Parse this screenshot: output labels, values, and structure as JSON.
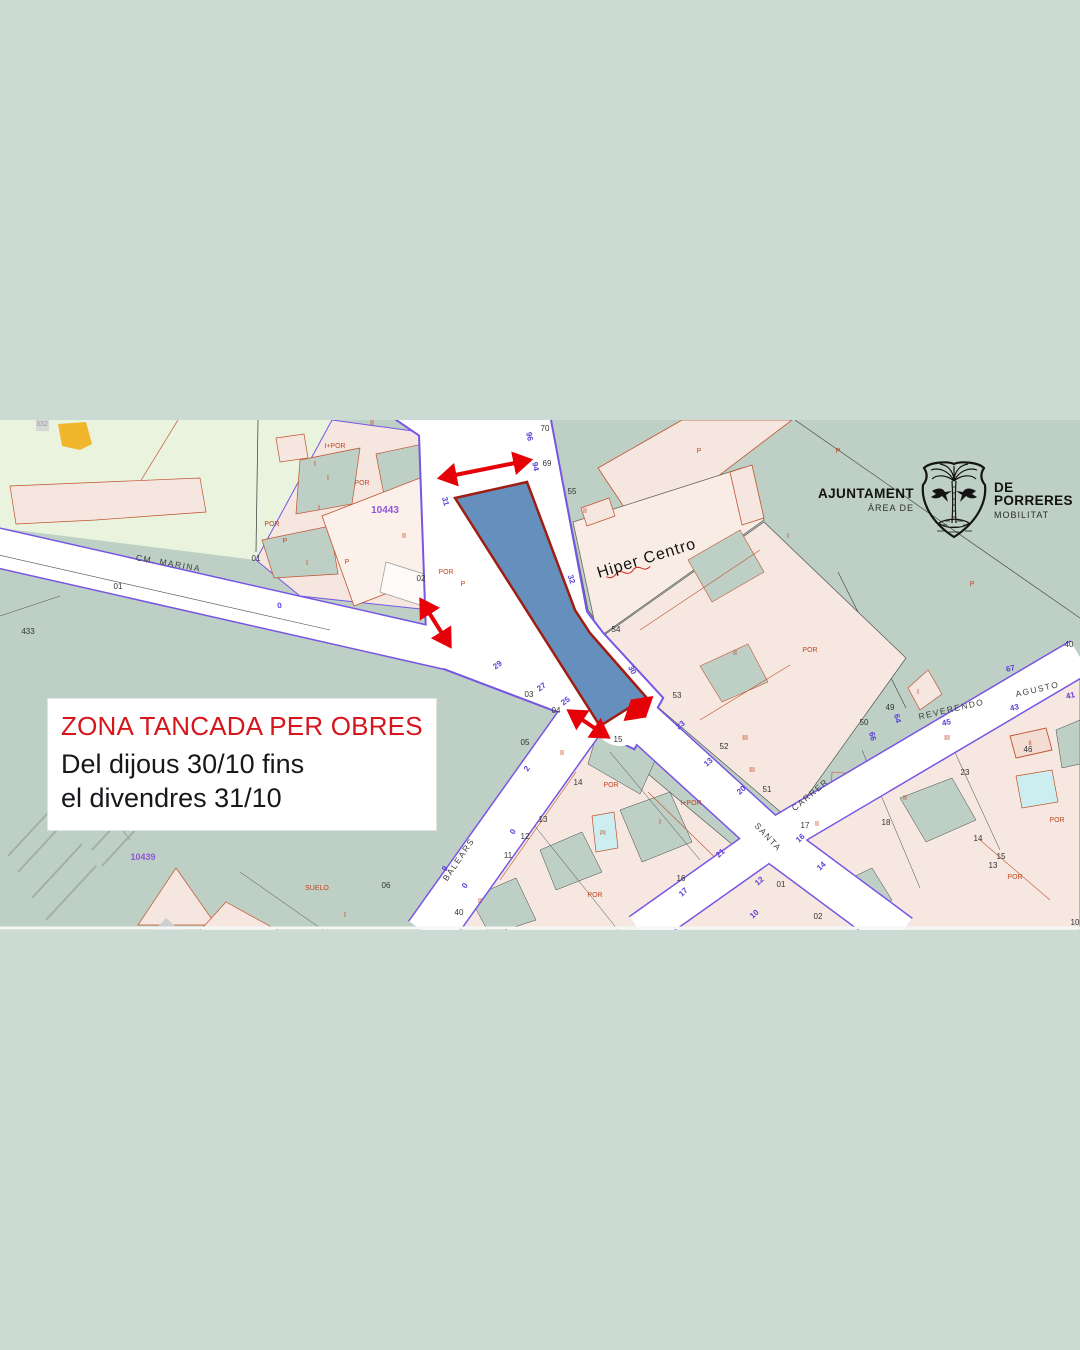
{
  "page": {
    "background": "#cbdad3"
  },
  "notice": {
    "title": "ZONA TANCADA PER OBRES",
    "line1": "Del dijous 30/10 fins",
    "line2": "el divendres 31/10",
    "title_color": "#d6161d"
  },
  "logo": {
    "org": "AJUNTAMENT",
    "org_sub": "ÀREA DE",
    "area": "DE PORRERES",
    "area_sub": "MOBILITAT"
  },
  "map": {
    "colors": {
      "field_light": "#e9f3de",
      "field_sage": "#bed0c5",
      "parcel_pink": "#f6e8e1",
      "parcel_border": "#c0522d",
      "street_line": "#7756e3",
      "pool_cyan": "#cdeef0",
      "zone_fill": "#6590bd",
      "zone_border": "#9f1d12",
      "arrow": "#e60008"
    },
    "arrow_color": "#e60008",
    "closed_zone": {
      "fill": "#6590bd",
      "stroke": "#9f1d12",
      "points": "455,78 527,62 575,190 590,213 646,277 600,306"
    },
    "arrows": [
      {
        "x1": 440,
        "y1": 58,
        "x2": 530,
        "y2": 40
      },
      {
        "x1": 421,
        "y1": 180,
        "x2": 450,
        "y2": 226
      },
      {
        "x1": 569,
        "y1": 291,
        "x2": 608,
        "y2": 317
      },
      {
        "x1": 651,
        "y1": 278,
        "x2": 626,
        "y2": 299
      }
    ],
    "labels": [
      {
        "t": "CM. MARINA",
        "x": 168,
        "y": 146,
        "r": 10,
        "s": 8.5,
        "c": "#3f3f3f",
        "ls": 1.5
      },
      {
        "t": "BALEARS",
        "x": 461,
        "y": 441,
        "r": -56,
        "s": 8.5,
        "c": "#3f3f3f",
        "ls": 1.5
      },
      {
        "t": "SANTA",
        "x": 766,
        "y": 419,
        "r": 47,
        "s": 8.5,
        "c": "#3f3f3f",
        "ls": 1.5
      },
      {
        "t": "CARRER",
        "x": 812,
        "y": 377,
        "r": -40,
        "s": 8.5,
        "c": "#3f3f3f",
        "ls": 1.5
      },
      {
        "t": "REVERENDO",
        "x": 952,
        "y": 292,
        "r": -13,
        "s": 8.5,
        "c": "#3f3f3f",
        "ls": 1.5
      },
      {
        "t": "AGUSTO",
        "x": 1038,
        "y": 272,
        "r": -13,
        "s": 8.5,
        "c": "#3f3f3f",
        "ls": 1.5
      },
      {
        "t": "Hiper Centro",
        "x": 648,
        "y": 143,
        "r": -17,
        "s": 16,
        "c": "#141414",
        "ls": 1
      },
      {
        "t": "332",
        "x": 42,
        "y": 6,
        "s": 7,
        "c": "#999999"
      },
      {
        "t": "70",
        "x": 545,
        "y": 11,
        "s": 8,
        "c": "#333333"
      },
      {
        "t": "69",
        "x": 547,
        "y": 46,
        "s": 8,
        "c": "#333333"
      },
      {
        "t": "55",
        "x": 572,
        "y": 74,
        "s": 8,
        "c": "#333333"
      },
      {
        "t": "54",
        "x": 616,
        "y": 212,
        "s": 8,
        "c": "#333333"
      },
      {
        "t": "53",
        "x": 677,
        "y": 278,
        "s": 8,
        "c": "#333333"
      },
      {
        "t": "52",
        "x": 724,
        "y": 329,
        "s": 8,
        "c": "#333333"
      },
      {
        "t": "51",
        "x": 767,
        "y": 372,
        "s": 8,
        "c": "#333333"
      },
      {
        "t": "50",
        "x": 864,
        "y": 305,
        "s": 8,
        "c": "#333333"
      },
      {
        "t": "49",
        "x": 890,
        "y": 290,
        "s": 8,
        "c": "#333333"
      },
      {
        "t": "40",
        "x": 1069,
        "y": 227,
        "s": 8,
        "c": "#333333"
      },
      {
        "t": "46",
        "x": 1028,
        "y": 332,
        "s": 8,
        "c": "#333333"
      },
      {
        "t": "23",
        "x": 965,
        "y": 355,
        "s": 8,
        "c": "#333333"
      },
      {
        "t": "17",
        "x": 805,
        "y": 408,
        "s": 8,
        "c": "#333333"
      },
      {
        "t": "18",
        "x": 886,
        "y": 405,
        "s": 8,
        "c": "#333333"
      },
      {
        "t": "14",
        "x": 978,
        "y": 421,
        "s": 8,
        "c": "#333333"
      },
      {
        "t": "15",
        "x": 1001,
        "y": 439,
        "s": 8,
        "c": "#333333"
      },
      {
        "t": "13",
        "x": 993,
        "y": 448,
        "s": 8,
        "c": "#333333"
      },
      {
        "t": "10",
        "x": 1075,
        "y": 505,
        "s": 8,
        "c": "#333333"
      },
      {
        "t": "02",
        "x": 421,
        "y": 161,
        "s": 8,
        "c": "#333333"
      },
      {
        "t": "01",
        "x": 256,
        "y": 141,
        "s": 8,
        "c": "#333333"
      },
      {
        "t": "433",
        "x": 28,
        "y": 214,
        "s": 8,
        "c": "#333333"
      },
      {
        "t": "01",
        "x": 118,
        "y": 169,
        "s": 8,
        "c": "#333333"
      },
      {
        "t": "03",
        "x": 529,
        "y": 277,
        "s": 8,
        "c": "#333333"
      },
      {
        "t": "04",
        "x": 556,
        "y": 293,
        "s": 8,
        "c": "#333333"
      },
      {
        "t": "05",
        "x": 525,
        "y": 325,
        "s": 8,
        "c": "#333333"
      },
      {
        "t": "06",
        "x": 386,
        "y": 468,
        "s": 8,
        "c": "#333333"
      },
      {
        "t": "15",
        "x": 618,
        "y": 322,
        "s": 8,
        "c": "#333333"
      },
      {
        "t": "14",
        "x": 578,
        "y": 365,
        "s": 8,
        "c": "#333333"
      },
      {
        "t": "13",
        "x": 543,
        "y": 402,
        "s": 8,
        "c": "#333333"
      },
      {
        "t": "12",
        "x": 525,
        "y": 419,
        "s": 8,
        "c": "#333333"
      },
      {
        "t": "11",
        "x": 508,
        "y": 438,
        "s": 8,
        "c": "#333333"
      },
      {
        "t": "40",
        "x": 459,
        "y": 495,
        "s": 8,
        "c": "#333333"
      },
      {
        "t": "16",
        "x": 681,
        "y": 461,
        "s": 8,
        "c": "#333333"
      },
      {
        "t": "01",
        "x": 781,
        "y": 467,
        "s": 8,
        "c": "#333333"
      },
      {
        "t": "02",
        "x": 818,
        "y": 499,
        "s": 8,
        "c": "#333333"
      },
      {
        "t": "10443",
        "x": 385,
        "y": 93,
        "s": 10,
        "c": "#9257d8",
        "w": "bold"
      },
      {
        "t": "10439",
        "x": 143,
        "y": 440,
        "s": 9,
        "c": "#9257d8",
        "w": "bold"
      },
      {
        "t": "96",
        "x": 527,
        "y": 17,
        "r": 78,
        "s": 8,
        "c": "#5b3fd8",
        "w": "bold"
      },
      {
        "t": "94",
        "x": 533,
        "y": 47,
        "r": 78,
        "s": 8,
        "c": "#5b3fd8",
        "w": "bold"
      },
      {
        "t": "31",
        "x": 443,
        "y": 82,
        "r": 75,
        "s": 8,
        "c": "#5b3fd8",
        "w": "bold"
      },
      {
        "t": "32",
        "x": 569,
        "y": 160,
        "r": 72,
        "s": 8,
        "c": "#5b3fd8",
        "w": "bold"
      },
      {
        "t": "30",
        "x": 630,
        "y": 251,
        "r": 62,
        "s": 8,
        "c": "#5b3fd8",
        "w": "bold"
      },
      {
        "t": "0",
        "x": 280,
        "y": 188,
        "r": -12,
        "s": 8,
        "c": "#5b3fd8",
        "w": "bold"
      },
      {
        "t": "29",
        "x": 499,
        "y": 247,
        "r": -36,
        "s": 8,
        "c": "#5b3fd8",
        "w": "bold"
      },
      {
        "t": "27",
        "x": 543,
        "y": 269,
        "r": -36,
        "s": 8,
        "c": "#5b3fd8",
        "w": "bold"
      },
      {
        "t": "25",
        "x": 567,
        "y": 283,
        "r": -36,
        "s": 8,
        "c": "#5b3fd8",
        "w": "bold"
      },
      {
        "t": "23",
        "x": 682,
        "y": 307,
        "r": -38,
        "s": 8,
        "c": "#5b3fd8",
        "w": "bold"
      },
      {
        "t": "13",
        "x": 710,
        "y": 344,
        "r": -42,
        "s": 8,
        "c": "#5b3fd8",
        "w": "bold"
      },
      {
        "t": "20",
        "x": 743,
        "y": 372,
        "r": -42,
        "s": 8,
        "c": "#5b3fd8",
        "w": "bold"
      },
      {
        "t": "21",
        "x": 722,
        "y": 435,
        "r": -42,
        "s": 8,
        "c": "#5b3fd8",
        "w": "bold"
      },
      {
        "t": "16",
        "x": 802,
        "y": 420,
        "r": -42,
        "s": 8,
        "c": "#5b3fd8",
        "w": "bold"
      },
      {
        "t": "14",
        "x": 823,
        "y": 448,
        "r": -42,
        "s": 8,
        "c": "#5b3fd8",
        "w": "bold"
      },
      {
        "t": "12",
        "x": 761,
        "y": 463,
        "r": -42,
        "s": 8,
        "c": "#5b3fd8",
        "w": "bold"
      },
      {
        "t": "17",
        "x": 685,
        "y": 474,
        "r": -42,
        "s": 8,
        "c": "#5b3fd8",
        "w": "bold"
      },
      {
        "t": "10",
        "x": 756,
        "y": 496,
        "r": -42,
        "s": 8,
        "c": "#5b3fd8",
        "w": "bold"
      },
      {
        "t": "67",
        "x": 1011,
        "y": 251,
        "r": -13,
        "s": 8,
        "c": "#5b3fd8",
        "w": "bold"
      },
      {
        "t": "45",
        "x": 947,
        "y": 305,
        "r": -13,
        "s": 8,
        "c": "#5b3fd8",
        "w": "bold"
      },
      {
        "t": "43",
        "x": 1015,
        "y": 290,
        "r": -13,
        "s": 8,
        "c": "#5b3fd8",
        "w": "bold"
      },
      {
        "t": "41",
        "x": 1071,
        "y": 278,
        "r": -13,
        "s": 8,
        "c": "#5b3fd8",
        "w": "bold"
      },
      {
        "t": "64",
        "x": 895,
        "y": 299,
        "r": 75,
        "s": 8,
        "c": "#5b3fd8",
        "w": "bold"
      },
      {
        "t": "66",
        "x": 870,
        "y": 317,
        "r": 75,
        "s": 8,
        "c": "#5b3fd8",
        "w": "bold"
      },
      {
        "t": "2",
        "x": 529,
        "y": 350,
        "r": -56,
        "s": 8,
        "c": "#5b3fd8",
        "w": "bold"
      },
      {
        "t": "0",
        "x": 515,
        "y": 413,
        "r": -56,
        "s": 8,
        "c": "#5b3fd8",
        "w": "bold"
      },
      {
        "t": "9",
        "x": 447,
        "y": 450,
        "r": -56,
        "s": 8,
        "c": "#5b3fd8",
        "w": "bold"
      },
      {
        "t": "0",
        "x": 467,
        "y": 467,
        "r": -56,
        "s": 8,
        "c": "#5b3fd8",
        "w": "bold"
      },
      {
        "t": "I+POR",
        "x": 335,
        "y": 28,
        "s": 7,
        "c": "#c2451f"
      },
      {
        "t": "POR",
        "x": 362,
        "y": 65,
        "s": 7,
        "c": "#c2451f"
      },
      {
        "t": "POR",
        "x": 272,
        "y": 106,
        "s": 7,
        "c": "#c2451f"
      },
      {
        "t": "POR",
        "x": 446,
        "y": 154,
        "s": 7,
        "c": "#c2451f"
      },
      {
        "t": "P",
        "x": 463,
        "y": 166,
        "s": 7,
        "c": "#c2451f"
      },
      {
        "t": "II",
        "x": 372,
        "y": 5,
        "s": 7,
        "c": "#c2451f"
      },
      {
        "t": "I",
        "x": 315,
        "y": 46,
        "s": 7,
        "c": "#c2451f"
      },
      {
        "t": "I",
        "x": 328,
        "y": 60,
        "s": 7,
        "c": "#c2451f"
      },
      {
        "t": "I",
        "x": 319,
        "y": 90,
        "s": 7,
        "c": "#c2451f"
      },
      {
        "t": "II",
        "x": 404,
        "y": 118,
        "s": 7,
        "c": "#c2451f"
      },
      {
        "t": "P",
        "x": 285,
        "y": 123,
        "s": 7,
        "c": "#c2451f"
      },
      {
        "t": "I",
        "x": 307,
        "y": 145,
        "s": 7,
        "c": "#c2451f"
      },
      {
        "t": "P",
        "x": 347,
        "y": 144,
        "s": 7,
        "c": "#c2451f"
      },
      {
        "t": "II",
        "x": 585,
        "y": 93,
        "s": 7,
        "c": "#c2451f"
      },
      {
        "t": "P",
        "x": 699,
        "y": 33,
        "s": 7,
        "c": "#c2451f"
      },
      {
        "t": "P",
        "x": 838,
        "y": 33,
        "s": 7,
        "c": "#c2451f"
      },
      {
        "t": "I",
        "x": 788,
        "y": 118,
        "s": 7,
        "c": "#c2451f"
      },
      {
        "t": "POR",
        "x": 810,
        "y": 232,
        "s": 7,
        "c": "#c2451f"
      },
      {
        "t": "P",
        "x": 972,
        "y": 166,
        "s": 7,
        "c": "#c2451f"
      },
      {
        "t": "II",
        "x": 735,
        "y": 235,
        "s": 7,
        "c": "#c2451f"
      },
      {
        "t": "III",
        "x": 745,
        "y": 320,
        "s": 7,
        "c": "#c2451f"
      },
      {
        "t": "III",
        "x": 752,
        "y": 352,
        "s": 7,
        "c": "#c2451f"
      },
      {
        "t": "II",
        "x": 817,
        "y": 406,
        "s": 7,
        "c": "#c2451f"
      },
      {
        "t": "I",
        "x": 918,
        "y": 274,
        "s": 7,
        "c": "#c2451f"
      },
      {
        "t": "III",
        "x": 947,
        "y": 320,
        "s": 7,
        "c": "#c2451f"
      },
      {
        "t": "II",
        "x": 1030,
        "y": 325,
        "s": 6,
        "c": "#c2451f"
      },
      {
        "t": "POR",
        "x": 1057,
        "y": 402,
        "s": 7,
        "c": "#c2451f"
      },
      {
        "t": "POR",
        "x": 1015,
        "y": 459,
        "s": 7,
        "c": "#c2451f"
      },
      {
        "t": "POR",
        "x": 611,
        "y": 367,
        "s": 7,
        "c": "#c2451f"
      },
      {
        "t": "I+POR",
        "x": 691,
        "y": 385,
        "s": 7,
        "c": "#c2451f"
      },
      {
        "t": "POR",
        "x": 595,
        "y": 477,
        "s": 7,
        "c": "#c2451f"
      },
      {
        "t": "PI",
        "x": 603,
        "y": 415,
        "s": 6,
        "c": "#c2451f"
      },
      {
        "t": "II",
        "x": 480,
        "y": 483,
        "s": 7,
        "c": "#c2451f"
      },
      {
        "t": "SUELO",
        "x": 317,
        "y": 470,
        "s": 7,
        "c": "#c2451f"
      },
      {
        "t": "I",
        "x": 345,
        "y": 497,
        "s": 7,
        "c": "#c2451f"
      },
      {
        "t": "II",
        "x": 905,
        "y": 380,
        "s": 7,
        "c": "#c2451f"
      },
      {
        "t": "I",
        "x": 660,
        "y": 404,
        "s": 7,
        "c": "#c2451f"
      },
      {
        "t": "II",
        "x": 562,
        "y": 335,
        "s": 7,
        "c": "#c2451f"
      }
    ]
  }
}
